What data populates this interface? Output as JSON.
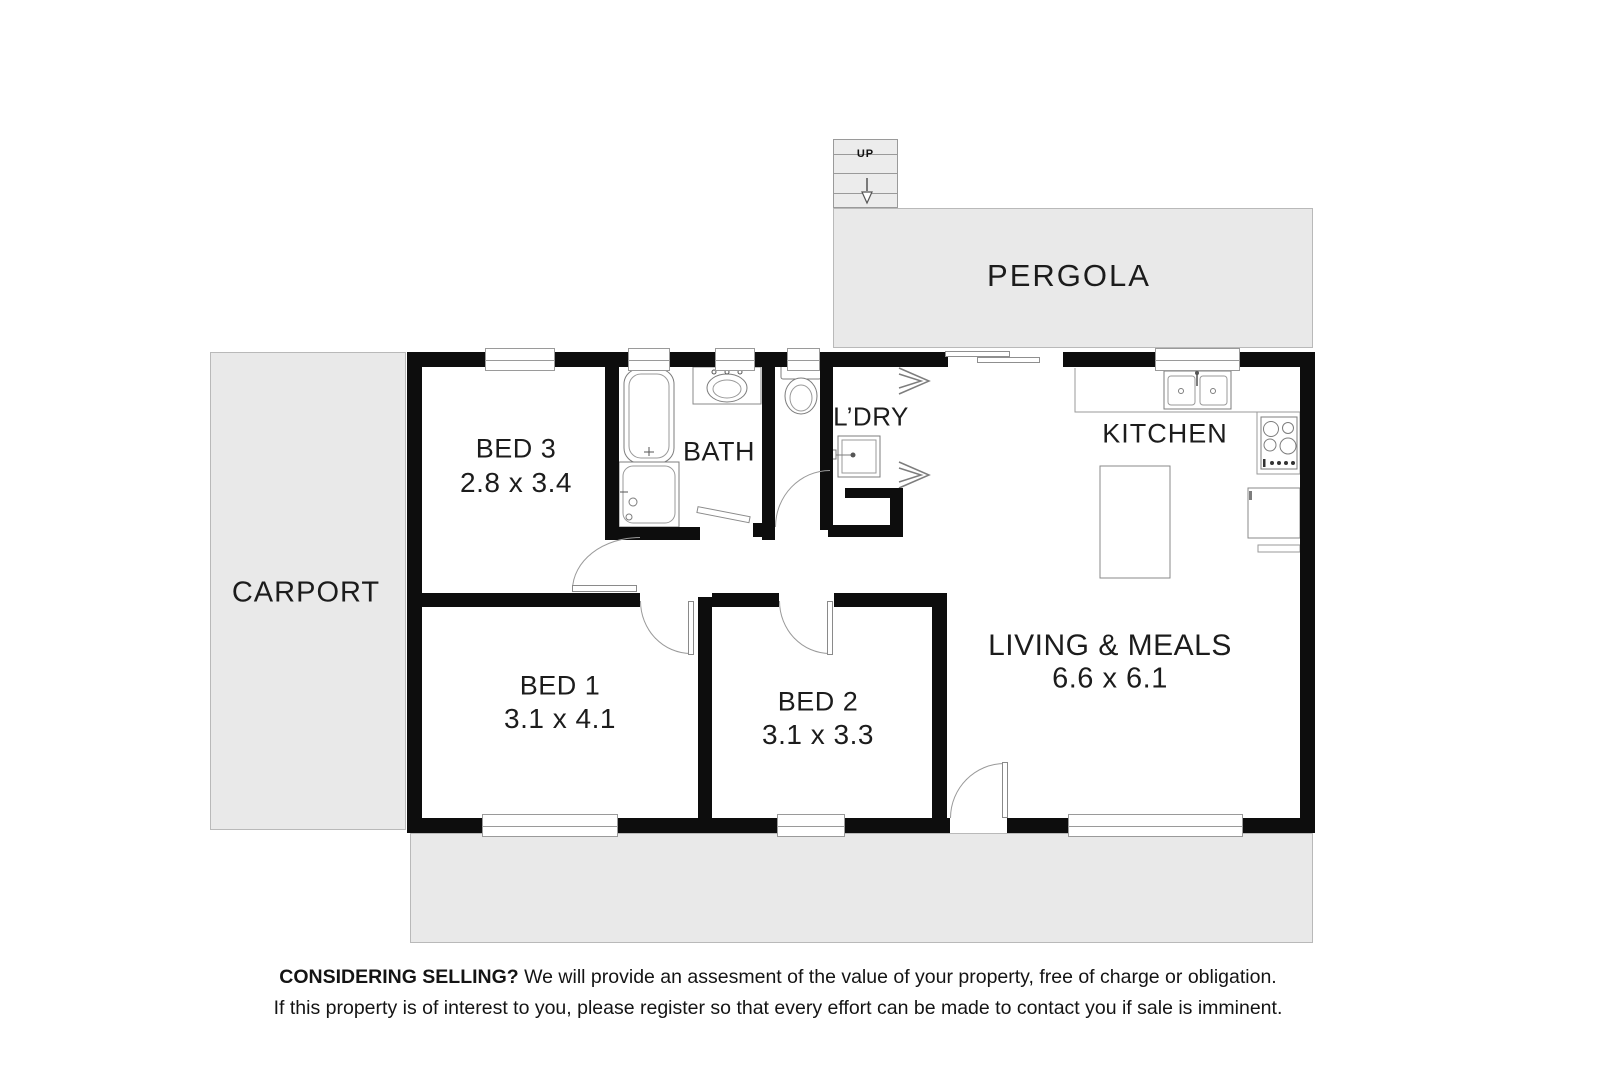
{
  "plan": {
    "rooms": [
      {
        "id": "bed3",
        "label": "BED 3",
        "dims": "2.8 x 3.4"
      },
      {
        "id": "bed1",
        "label": "BED 1",
        "dims": "3.1 x 4.1"
      },
      {
        "id": "bed2",
        "label": "BED 2",
        "dims": "3.1 x 3.3"
      },
      {
        "id": "living",
        "label": "LIVING & MEALS",
        "dims": "6.6 x 6.1"
      },
      {
        "id": "kitchen",
        "label": "KITCHEN",
        "dims": ""
      },
      {
        "id": "bath",
        "label": "BATH",
        "dims": ""
      },
      {
        "id": "laundry",
        "label": "L’DRY",
        "dims": ""
      },
      {
        "id": "carport",
        "label": "CARPORT",
        "dims": ""
      },
      {
        "id": "pergola",
        "label": "PERGOLA",
        "dims": ""
      }
    ],
    "stairs_label": "UP",
    "fixtures": [
      "bathtub",
      "shower",
      "basin",
      "toilet",
      "laundry-trough",
      "kitchen-sink",
      "cooktop",
      "kitchen-bench",
      "island-bench",
      "refrigerator"
    ],
    "colors": {
      "wall": "#0d0d0d",
      "outdoor_fill": "#e9e9e9",
      "outdoor_border": "#b9b9b9",
      "fixture_line": "#7d7d7d",
      "text": "#1c1c1c"
    }
  },
  "footer": {
    "line1_bold": "CONSIDERING SELLING?",
    "line1_rest": " We will provide an assesment of the value of your property, free of charge or obligation.",
    "line2": "If this property is of interest to you, please register so that every effort can be made to contact you if sale is imminent."
  }
}
